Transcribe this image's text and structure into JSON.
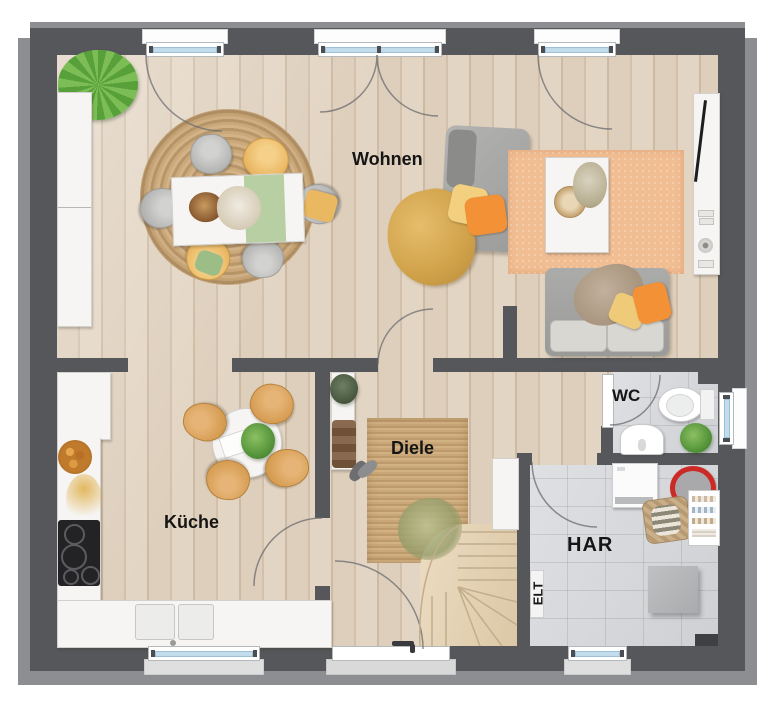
{
  "plan": {
    "type": "floor-plan-ground-floor",
    "rooms": {
      "wohnen": {
        "label": "Wohnen"
      },
      "kueche": {
        "label": "Küche"
      },
      "diele": {
        "label": "Diele"
      },
      "wc": {
        "label": "WC"
      },
      "har": {
        "label": "HAR"
      },
      "elt": {
        "label": "ELT"
      }
    },
    "colors": {
      "wall": "#56575b",
      "wall_shadow": "#8d8e92",
      "wood_floor": "#dbccba",
      "tile_floor": "#d5d6d8",
      "jute_rug": "#c5a376",
      "orange_rug": "#f1bd92",
      "window_glass": "#c3dcec",
      "accent_orange": "#f29135",
      "accent_yellow": "#e7b25c",
      "label_text": "#151515"
    }
  }
}
